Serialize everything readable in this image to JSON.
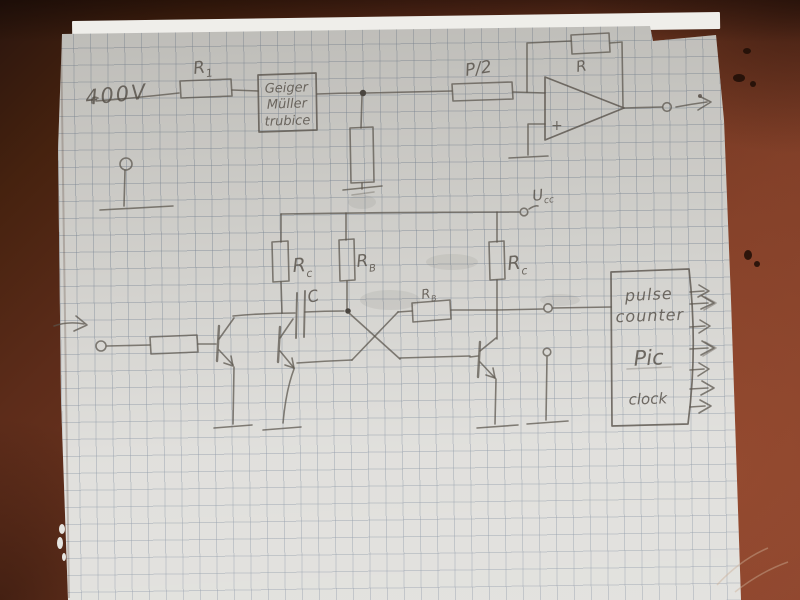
{
  "scene": {
    "type": "photograph of a hand-drawn Geiger-Muller counter schematic on squared paper",
    "colors": {
      "table": "#7c3c27",
      "table_dark": "#2f180e",
      "paper": "#dbdad6",
      "grid_line": "#8b99a8",
      "pencil": "#59534b"
    }
  },
  "labels": {
    "supply_voltage": "400V",
    "r1": {
      "main": "R",
      "sub": "1"
    },
    "tube": {
      "l1": "Geiger",
      "l2": "Müller",
      "l3": "trubice"
    },
    "divider": "P/2",
    "feedback_resistor": "R",
    "opamp_plus_input": "+",
    "ucc": {
      "main": "U",
      "sub": "cc"
    },
    "rc_left": {
      "main": "R",
      "sub": "c"
    },
    "rb_left": {
      "main": "R",
      "sub": "B"
    },
    "capacitor": "C",
    "rb_mid": {
      "main": "R",
      "sub": "B"
    },
    "rc_right": {
      "main": "R",
      "sub": "c"
    },
    "counter": {
      "l1": "pulse",
      "l2": "counter",
      "l3": "Pic",
      "l4": "clock"
    }
  }
}
